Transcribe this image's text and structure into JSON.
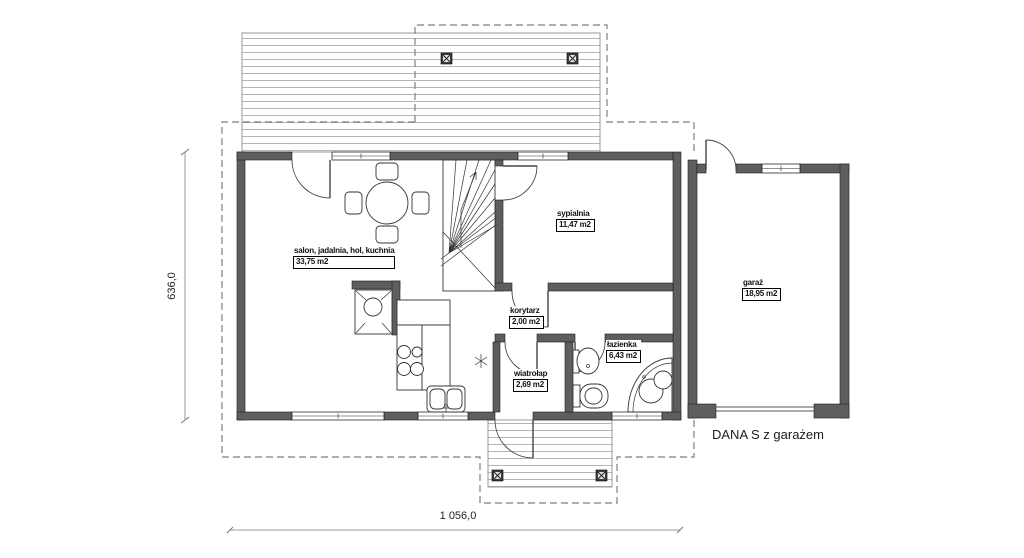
{
  "title": "DANA S z garażem",
  "plan": {
    "bottom_dimension": "1 056,0",
    "left_dimension": "636,0"
  },
  "rooms": [
    {
      "name": "salon, jadalnia, hol, kuchnia",
      "area": "33,75 m2"
    },
    {
      "name": "sypialnia",
      "area": "11,47 m2"
    },
    {
      "name": "korytarz",
      "area": "2,00 m2"
    },
    {
      "name": "łazienka",
      "area": "6,43 m2"
    },
    {
      "name": "wiatrołap",
      "area": "2,69 m2"
    },
    {
      "name": "garaż",
      "area": "18,95 m2"
    }
  ],
  "colors": {
    "wall": "#5e5e5e",
    "line": "#333333",
    "deck-line": "#b5b5b5",
    "dash": "#7e7e7e",
    "dim": "#9a9a9a",
    "text": "#111111",
    "bg": "#ffffff"
  }
}
